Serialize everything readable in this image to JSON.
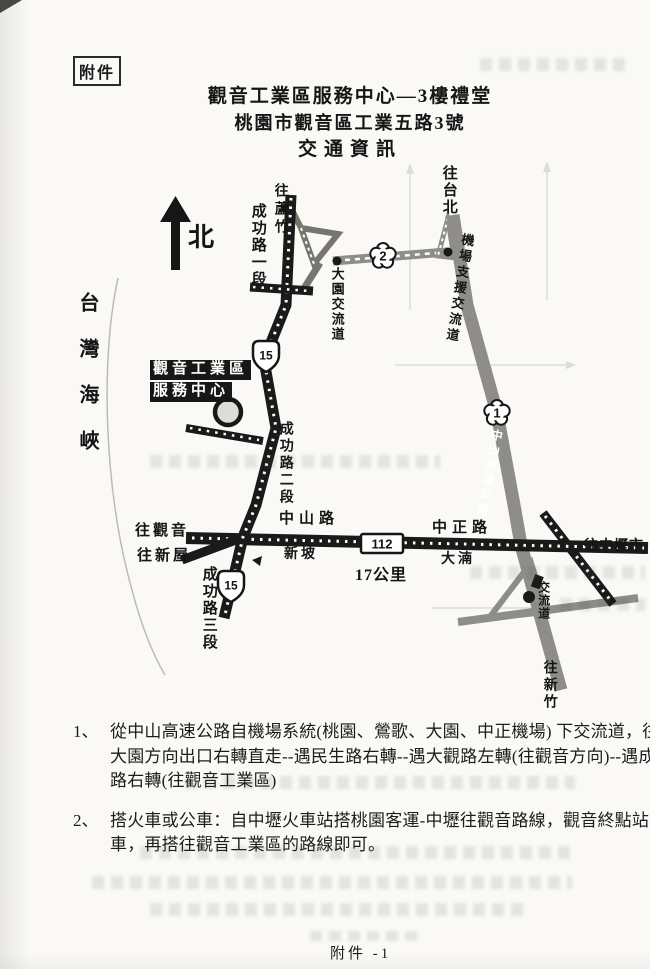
{
  "page": {
    "attachment_label": "附件",
    "title_line1": "觀音工業區服務中心—3樓禮堂",
    "title_line2": "桃園市觀音區工業五路3號",
    "title_line3": "交通資訊",
    "footer_label": "附件 -1"
  },
  "map": {
    "north": "北",
    "sea": "台灣海峽",
    "to_luzhu": "往蘆竹",
    "to_taipei": "往台北",
    "chenggong_sec1": "成功路一段",
    "chenggong_sec2": "成功路二段",
    "chenggong_sec3": "成功路三段",
    "dayuan_interchange": "大園交流道",
    "airport_interchange": "機場支援交流道",
    "zhongshan_highway": "中山高速公路",
    "service_center_line1": "觀音工業區",
    "service_center_line2": "服務中心",
    "zhongshan_rd": "中山路",
    "zhongzheng_rd": "中正路",
    "xinpo": "新坡",
    "danan": "大湳",
    "distance": "17公里",
    "to_guanyin": "往觀音",
    "to_xinwu": "往新屋",
    "to_zhongli": "往中壢市",
    "interchange": "交流道",
    "to_hsinchu": "往新竹",
    "badge_1": "1",
    "badge_2": "2",
    "badge_15": "15",
    "badge_112": "112"
  },
  "directions": {
    "item1": {
      "number": "1、",
      "line1": "從中山高速公路自機場系統(桃園、鶯歌、大園、中正機場) 下交流道，往",
      "line2": "大園方向出口右轉直走--遇民生路右轉--遇大觀路左轉(往觀音方向)--遇成功",
      "line3": "路右轉(往觀音工業區)"
    },
    "item2": {
      "number": "2、",
      "line1": "搭火車或公車：自中壢火車站搭桃園客運-中壢往觀音路線，觀音終點站下",
      "line2": "車，再搭往觀音工業區的路線即可。"
    }
  }
}
